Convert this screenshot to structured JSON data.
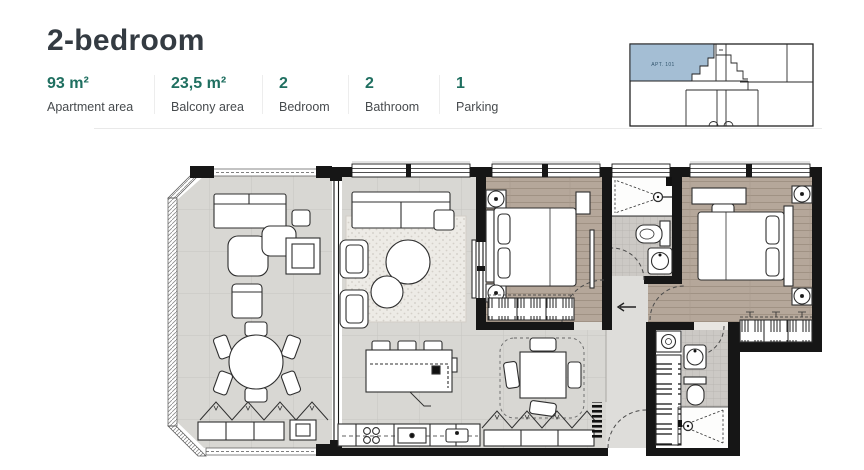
{
  "header": {
    "title": "2-bedroom"
  },
  "stats": [
    {
      "value": "93 m²",
      "label": "Apartment area"
    },
    {
      "value": "23,5 m²",
      "label": "Balcony area"
    },
    {
      "value": "2",
      "label": "Bedroom"
    },
    {
      "value": "2",
      "label": "Bathroom"
    },
    {
      "value": "1",
      "label": "Parking"
    }
  ],
  "minimap": {
    "apartment_label": "APT. 101",
    "highlight_color": "#a4bed4"
  },
  "colors": {
    "title_text": "#343b42",
    "stat_value_teal": "#1f6f60",
    "stat_label_gray": "#474b4e",
    "divider": "#e9e9e9",
    "wall_black": "#161616",
    "wood_floor": "#b5a79a",
    "tile_floor": "#ccc9c5",
    "living_floor": "#d8d7d3",
    "minimap_highlight": "#a4bed4"
  }
}
